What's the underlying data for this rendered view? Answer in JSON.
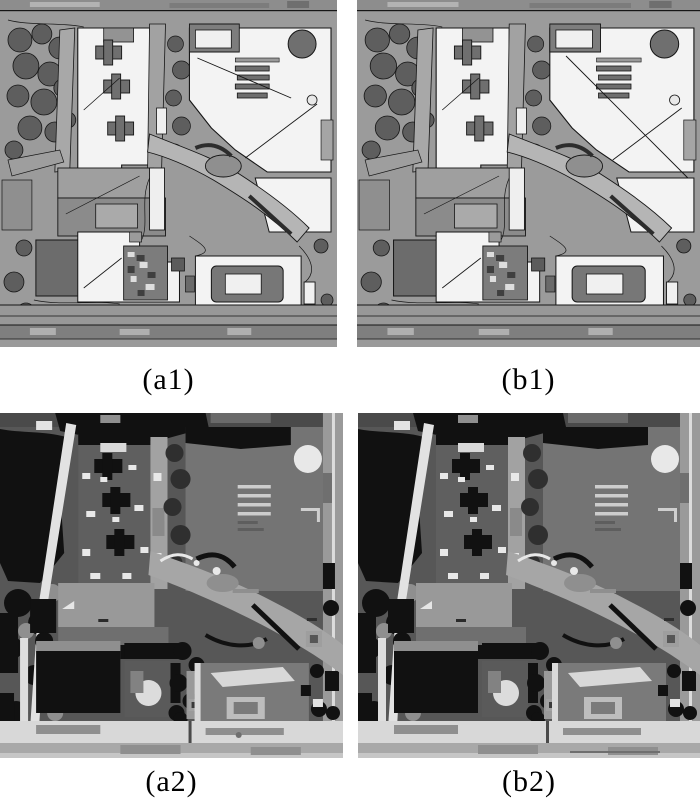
{
  "page": {
    "width": 700,
    "height": 806,
    "background": "#ffffff"
  },
  "figure": {
    "kind": "paper-figure-2x2-grayscale-segmentation-comparison",
    "panels": [
      {
        "id": "a1",
        "label": "(a1)",
        "row": 1,
        "content": "aerial image with segmentation boundary overlay, method a"
      },
      {
        "id": "b1",
        "label": "(b1)",
        "row": 1,
        "content": "aerial image with segmentation boundary overlay, method b"
      },
      {
        "id": "a2",
        "label": "(a2)",
        "row": 2,
        "content": "flat gray-level segmentation label map, method a"
      },
      {
        "id": "b2",
        "label": "(b2)",
        "row": 2,
        "content": "flat gray-level segmentation label map, method b"
      }
    ],
    "palette": {
      "label-color": "#000000",
      "ground": "#9b9b9b",
      "line": "#161616",
      "roof-white": "#f3f3f3",
      "tree": "#5e5e5e",
      "road-light": "#b5b5b5",
      "seg-bg": "#575757",
      "seg-black": "#111111",
      "seg-bldg": "#747474",
      "seg-white": "#e8e8e8",
      "seg-road": "#d8d8d8",
      "seg-road-diag": "#a6a6a6"
    }
  }
}
